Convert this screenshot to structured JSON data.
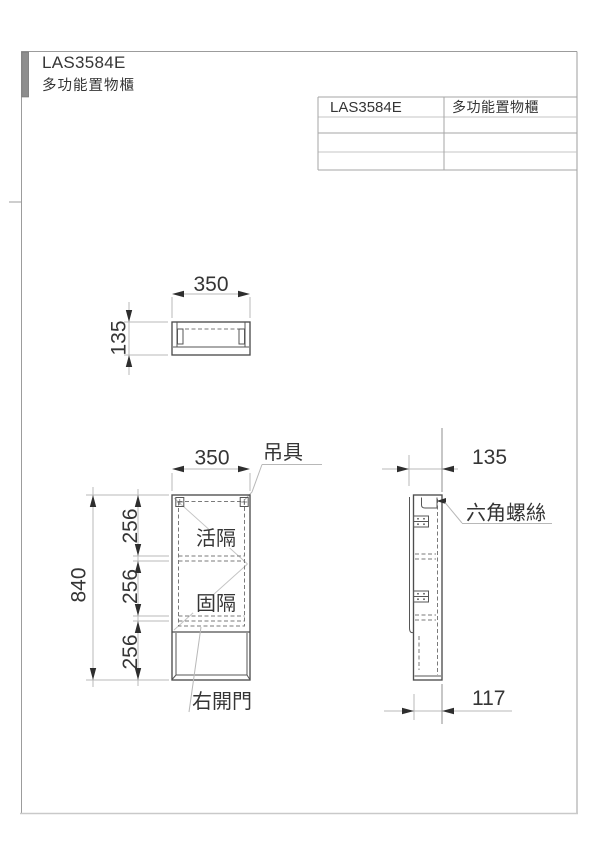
{
  "doc": {
    "header": {
      "model": "LAS3584E",
      "product": "多功能置物櫃"
    },
    "info_table": {
      "rows": [
        {
          "model": "LAS3584E",
          "product": "多功能置物櫃"
        }
      ],
      "empty_row_count": 3
    },
    "top_view": {
      "dim_width": "350",
      "dim_depth": "135"
    },
    "front_view": {
      "dim_width": "350",
      "dim_total_height": "840",
      "dim_seg_top": "256",
      "dim_seg_mid": "256",
      "dim_seg_bottom": "256",
      "label_hanger": "吊具",
      "label_movable_shelf": "活隔",
      "label_fixed_shelf": "固隔",
      "label_door": "右開門"
    },
    "side_view": {
      "dim_depth": "135",
      "label_hex_screw": "六角螺絲",
      "dim_inner_depth": "117"
    },
    "colors": {
      "line": "#4d4d4d",
      "dim_line": "#b8b8b8",
      "text": "#353535",
      "binding_bar": "#8e8e8e",
      "background": "#ffffff"
    }
  }
}
